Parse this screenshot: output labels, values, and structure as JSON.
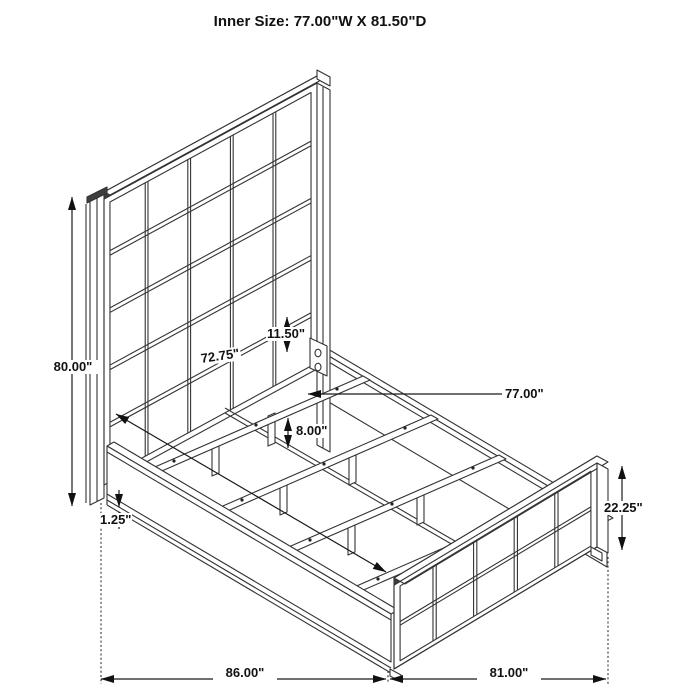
{
  "title": "Inner Size: 77.00\"W X 81.50\"D",
  "diagram": {
    "dimensions": {
      "overall_height": "80.00\"",
      "inner_length": "72.75\"",
      "rail_height": "11.50\"",
      "inner_width": "77.00\"",
      "leg_height": "8.00\"",
      "bottom_lip": "1.25\"",
      "footboard_height": "22.25\"",
      "overall_length": "86.00\"",
      "overall_width": "81.00\""
    }
  }
}
